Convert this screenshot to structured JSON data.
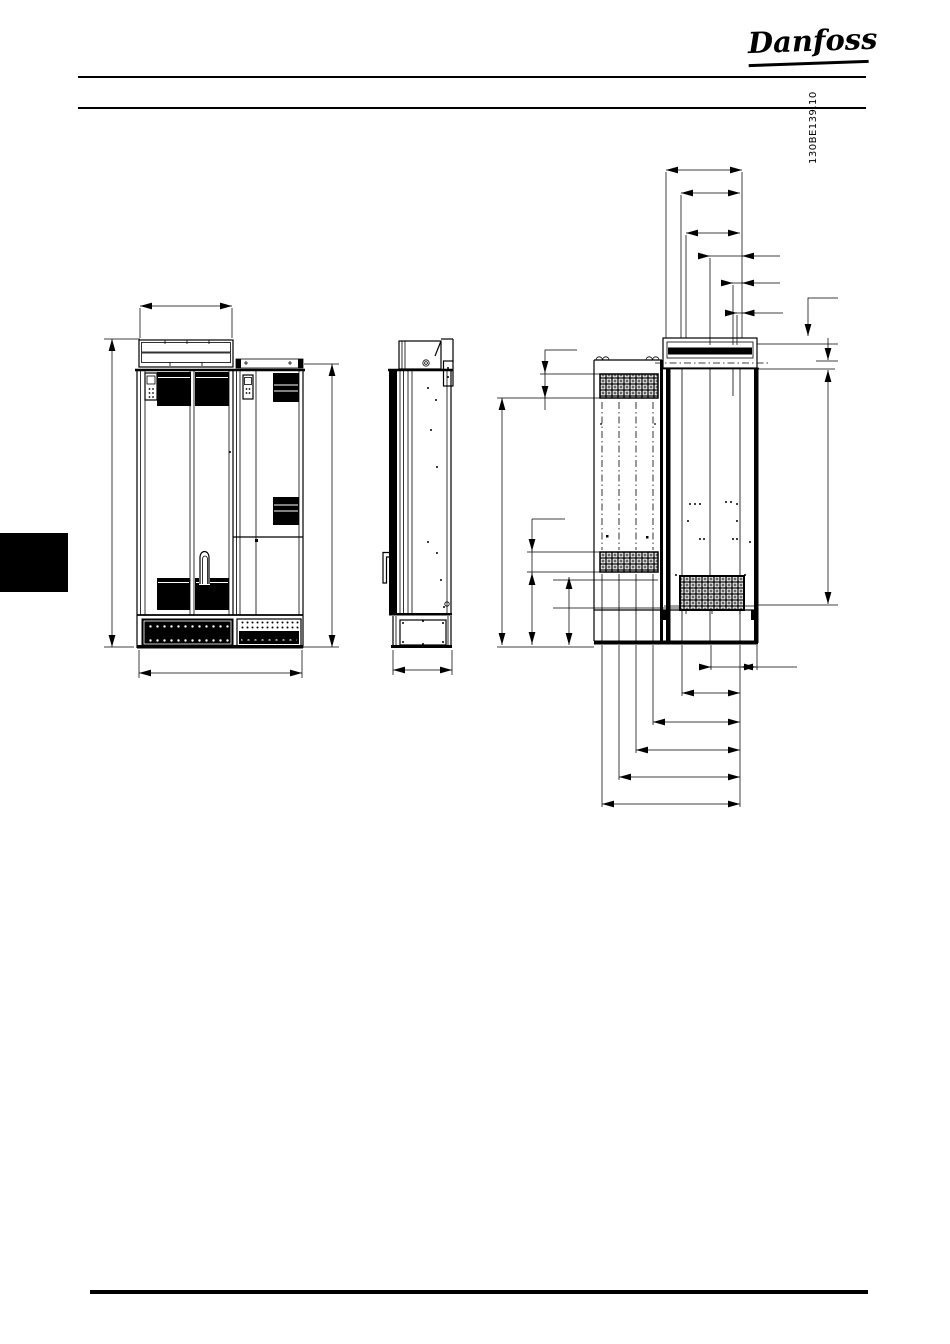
{
  "page": {
    "background": "#ffffff",
    "ink_color": "#000000",
    "width": 950,
    "height": 1344
  },
  "header": {
    "logo_text": "Danfoss"
  },
  "figure": {
    "drawing_id": "130BE139.10"
  }
}
